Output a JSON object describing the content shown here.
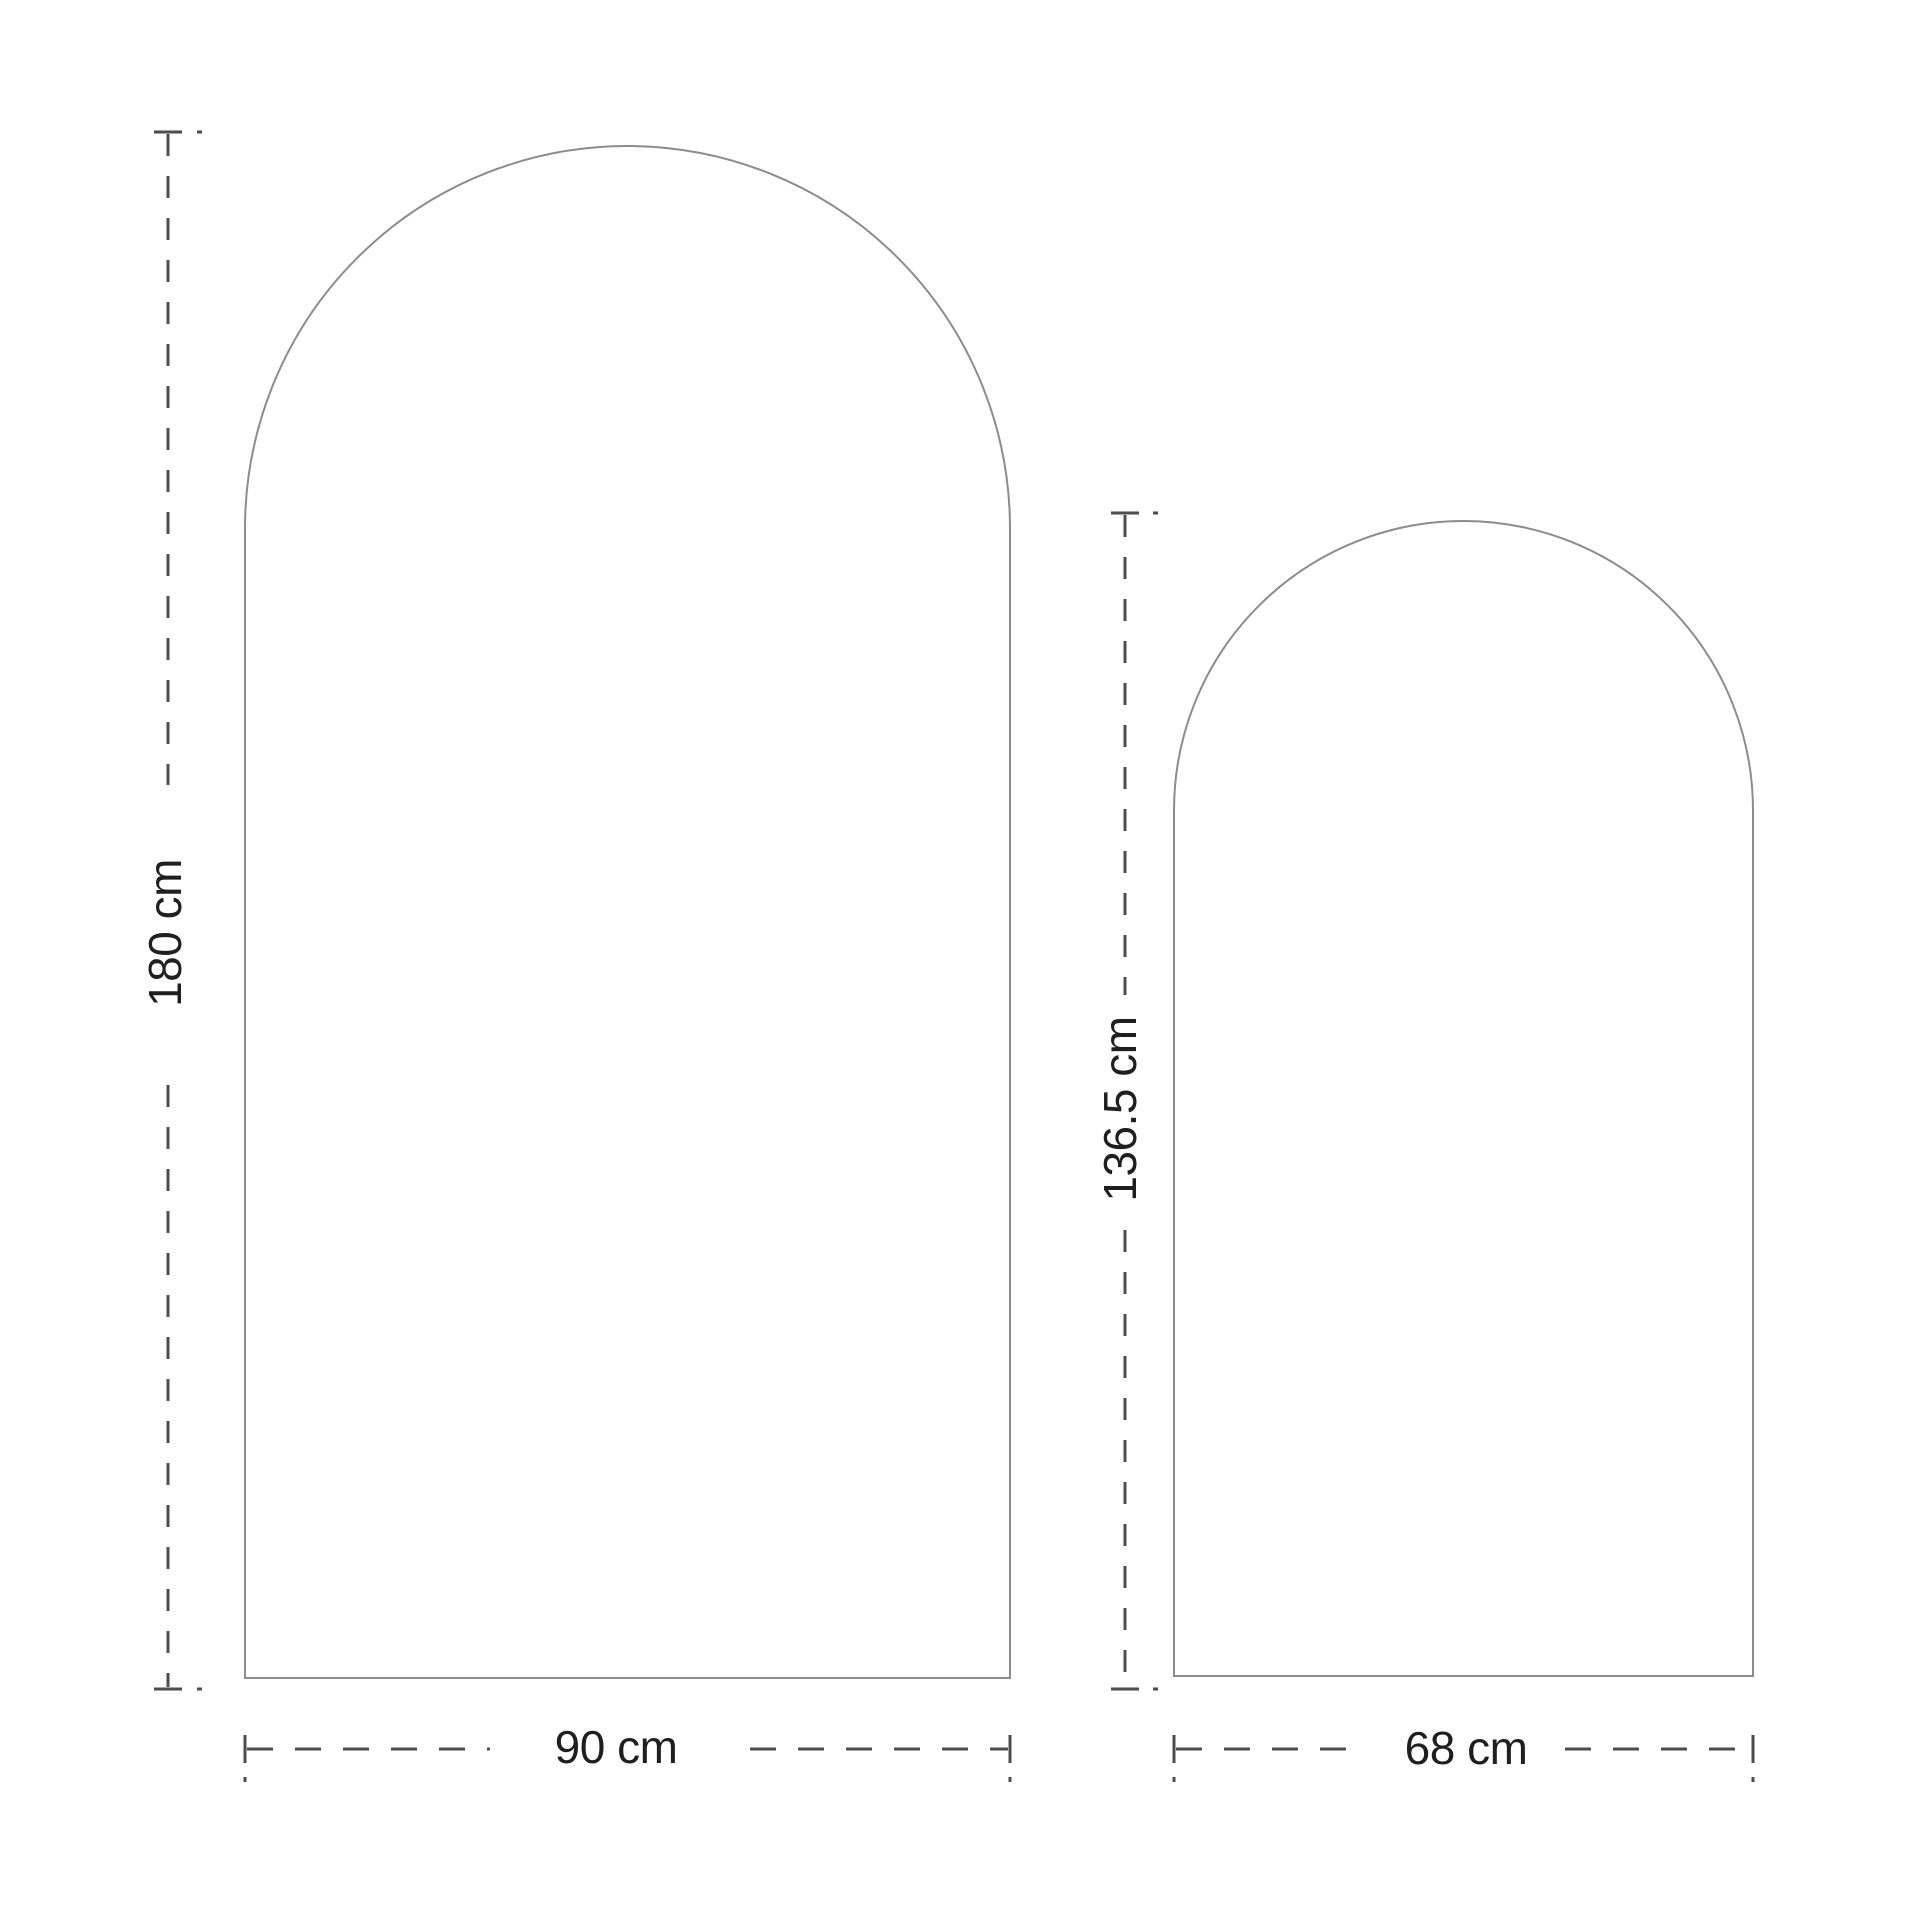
{
  "diagram": {
    "kind": "product-dimension-diagram",
    "shapes": [
      {
        "name": "large arch panel",
        "height_label": "180 cm",
        "width_label": "90 cm",
        "height_cm": 180,
        "width_cm": 90
      },
      {
        "name": "small arch panel",
        "height_label": "136.5 cm",
        "width_label": "68 cm",
        "height_cm": 136.5,
        "width_cm": 68
      }
    ],
    "colors": {
      "background": "#ffffff",
      "shape_outline": "#8c8c8c",
      "dimension_line": "#4d4d4d",
      "label_text": "#1f1f1f"
    }
  }
}
